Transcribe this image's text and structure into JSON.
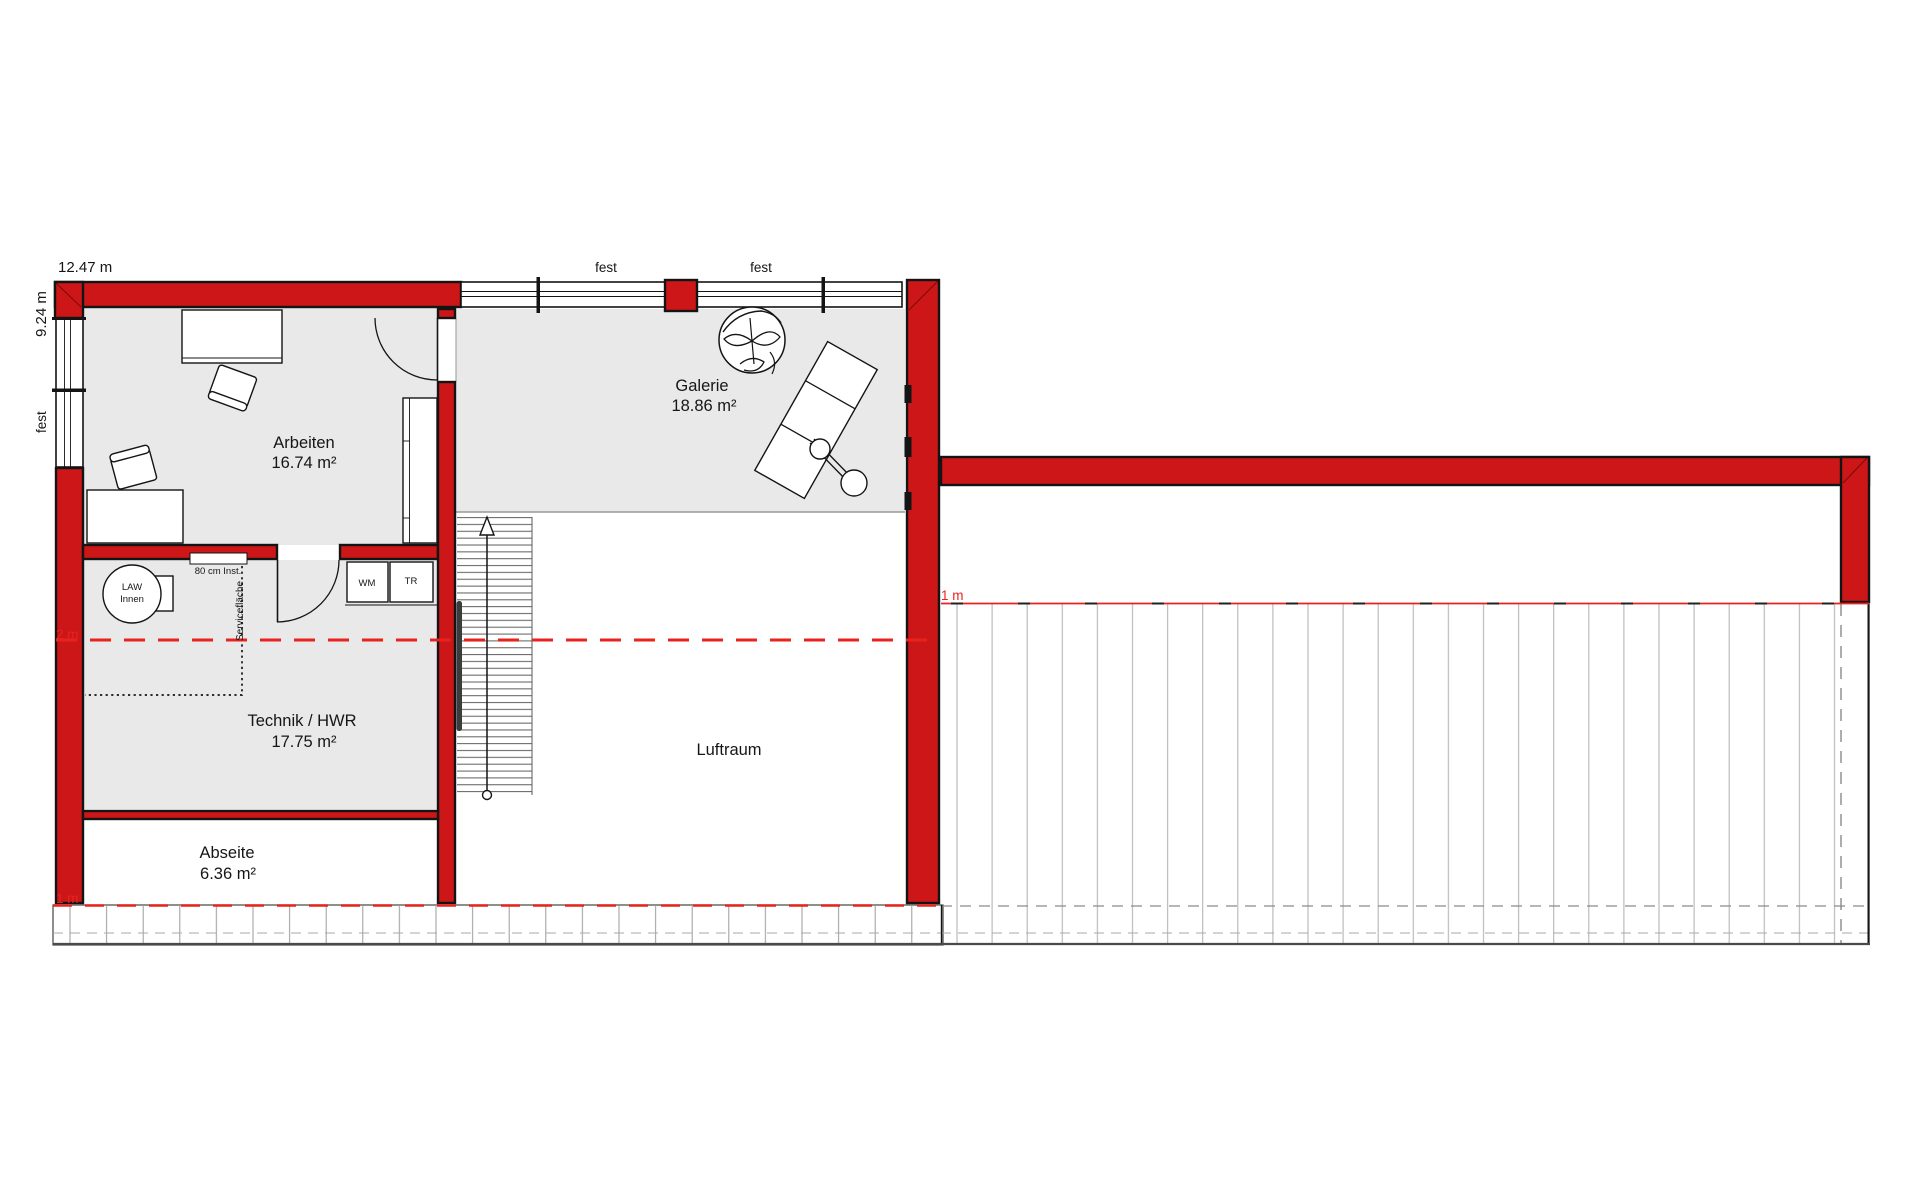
{
  "dimensions": {
    "width": "12.47 m",
    "height": "9.24 m"
  },
  "windows": {
    "fest_left": "fest",
    "fest_top_1": "fest",
    "fest_top_2": "fest"
  },
  "rooms": {
    "arbeiten": {
      "name": "Arbeiten",
      "area": "16.74 m²"
    },
    "galerie": {
      "name": "Galerie",
      "area": "18.86 m²"
    },
    "technik": {
      "name": "Technik / HWR",
      "area": "17.75 m²"
    },
    "abseite": {
      "name": "Abseite",
      "area": "6.36 m²"
    },
    "luftraum": {
      "name": "Luftraum"
    }
  },
  "equipment": {
    "law_line1": "LAW",
    "law_line2": "Innen",
    "washer": "WM",
    "dryer": "TR",
    "inst_niche": "80 cm Inst.",
    "service_area": "Servicefläche"
  },
  "height_lines": {
    "left_2m": "2 m",
    "left_1m": "1 m",
    "right_1m": "1 m"
  },
  "colors": {
    "wall_red": "#cc1617",
    "accent_red": "#e8231f",
    "room_fill": "#e9e9e9",
    "line_black": "#141414",
    "hatch_gray": "#b5b5b5",
    "divider_gray": "#999999"
  }
}
